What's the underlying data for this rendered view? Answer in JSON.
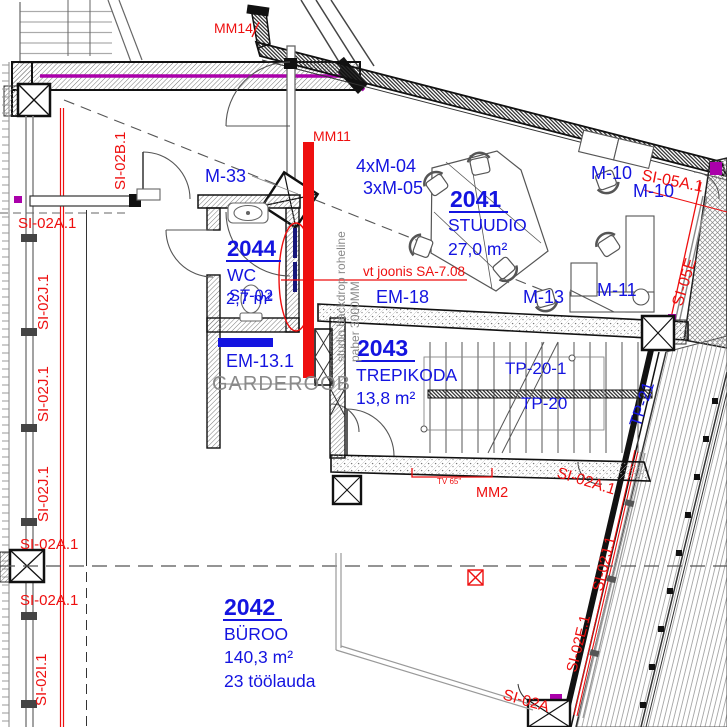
{
  "drawing": {
    "rooms": {
      "studio": {
        "number": "2041",
        "name": "STUUDIO",
        "area": "27,0 m²"
      },
      "buroo": {
        "number": "2042",
        "name": "BÜROO",
        "area": "140,3 m²",
        "note": "23 töölauda"
      },
      "trepikoda": {
        "number": "2043",
        "name": "TREPIKODA",
        "area": "13,8 m²"
      },
      "wc": {
        "number": "2044",
        "name": "WC",
        "area": "2,7 m²",
        "overlay": "ST-02"
      }
    },
    "equipment": {
      "m33": "M-33",
      "m04": "4xM-04",
      "m05": "3xM-05",
      "m10": "M-10",
      "m11": "M-11",
      "m13": "M-13",
      "em18": "EM-18",
      "em131": "EM-13.1",
      "tp201": "TP-20-1",
      "tp20": "TP-20",
      "tp21": "TP-21"
    },
    "notes": {
      "garderoob": "GARDEROOB",
      "backdrop1": "studio backdrop roheline",
      "backdrop2": "paber 3000MM",
      "vt": "vt joonis SA-7.08",
      "tv": "TV 65\"",
      "mm14": "MM14",
      "mm11": "MM11",
      "mm2": "MM2"
    },
    "wall_codes": {
      "si02b1": "SI-02B.1",
      "si02a1": "SI-02A.1",
      "si02j1": "SI-02J.1",
      "si02i1": "SI-02I.1",
      "si02e1": "SI-02E.1",
      "si05a1": "SI-05A.1",
      "si05e": "SI-05E",
      "si02a": "SI-02A"
    },
    "colors": {
      "label_blue": "#1414e0",
      "annotation_red": "#ee0f0f",
      "note_gray": "#8a8a8a",
      "accent_magenta": "#aa00aa"
    }
  }
}
